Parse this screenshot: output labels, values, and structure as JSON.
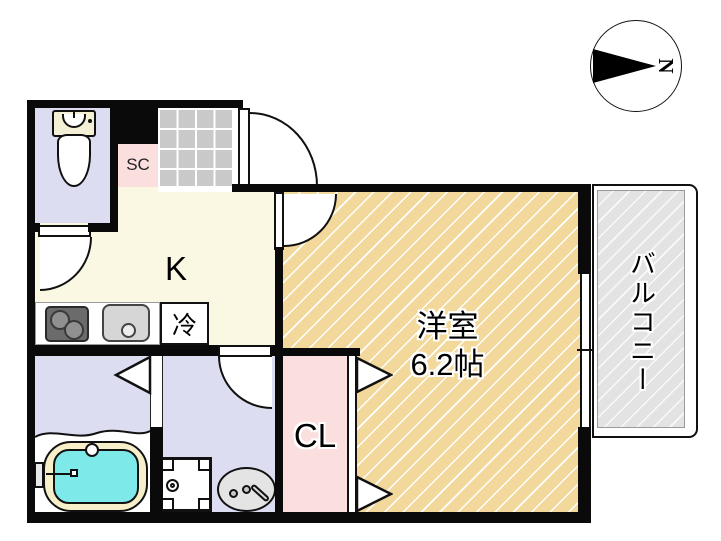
{
  "type": "apartment-floor-plan",
  "compass": {
    "north_label": "N",
    "needle_direction": "right"
  },
  "labels": {
    "kitchen": "K",
    "refrigerator": "冷",
    "shoe_closet": "SC",
    "closet": "CL",
    "western_room": "洋室",
    "western_room_size": "6.2帖",
    "balcony": "バルコニー"
  },
  "fixtures": [
    "toilet",
    "bathtub",
    "bath-faucet",
    "washbasin",
    "washing-machine-pan",
    "gas-stove",
    "kitchen-sink",
    "entrance-tile",
    "sliding-window",
    "hinged-doors",
    "folding-door-triangles"
  ],
  "colors": {
    "wall": "#0a0a0a",
    "kitchen_floor": "#FAF7E3",
    "western_room_floor": "#F2D89B",
    "wet_area_floor": "#DDDDF1",
    "closet_pink": "#FBDFDF",
    "entrance_tile": "#C9C9C9",
    "balcony_gray": "#E3E3E3",
    "bathtub_water": "#7EE9E9",
    "bathtub_rim": "#F6EFC9"
  }
}
